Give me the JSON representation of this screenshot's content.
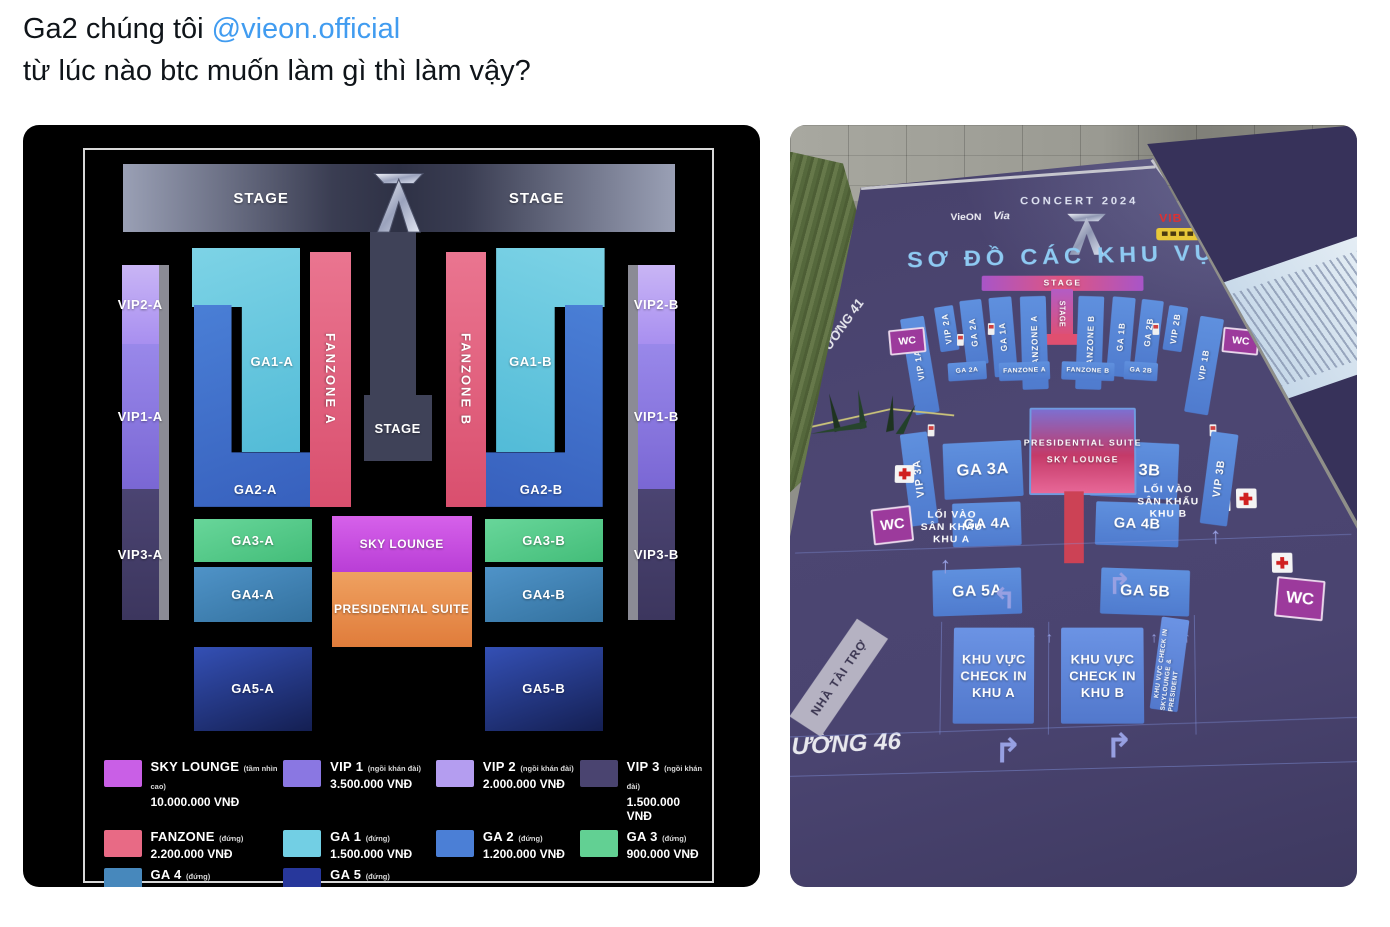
{
  "tweet": {
    "text_prefix": "Ga2 chúng tôi ",
    "mention": "@vieon.official",
    "line2": "từ lúc nào btc muốn làm gì thì làm vậy?"
  },
  "colors": {
    "link_blue": "#419cf0",
    "body_text": "#0f1419",
    "seatmap_bg": "#000000",
    "ga1": "#72cfe4",
    "ga2": "#4b7fd6",
    "ga3": "#62d093",
    "ga4": "#4788bc",
    "ga5": "#27379b",
    "fanzone": "#e86a85",
    "vip1": "#8a77e2",
    "vip2": "#b49df0",
    "vip3": "#4a4470",
    "sky_lounge": "#c95fe6",
    "presidential": "#e8914f",
    "photo_board_purple": "#47416b",
    "photo_zone_blue": "#5b8cd9",
    "photo_stage_pink": "#d4537c",
    "wc_magenta": "#9c3a9c",
    "photo_title_blue": "#8ecaf2"
  },
  "seat_map": {
    "stage_left": "STAGE",
    "stage_right": "STAGE",
    "stage_center": "STAGE",
    "zones": {
      "vip2a": "VIP2-A",
      "vip1a": "VIP1-A",
      "vip3a": "VIP3-A",
      "vip2b": "VIP2-B",
      "vip1b": "VIP1-B",
      "vip3b": "VIP3-B",
      "ga1a": "GA1-A",
      "ga2a": "GA2-A",
      "ga3a": "GA3-A",
      "ga4a": "GA4-A",
      "ga5a": "GA5-A",
      "ga1b": "GA1-B",
      "ga2b": "GA2-B",
      "ga3b": "GA3-B",
      "ga4b": "GA4-B",
      "ga5b": "GA5-B",
      "fanzone_a": "FANZONE A",
      "fanzone_b": "FANZONE B",
      "sky_lounge": "SKY LOUNGE",
      "presidential": "PRESIDENTIAL SUITE"
    },
    "legend": [
      {
        "name": "SKY LOUNGE",
        "note": "(tầm nhìn cao)",
        "price": "10.000.000 VNĐ",
        "color": "#c95fe6"
      },
      {
        "name": "VIP 1",
        "note": "(ngồi khán đài)",
        "price": "3.500.000 VNĐ",
        "color": "#8a77e2"
      },
      {
        "name": "VIP 2",
        "note": "(ngồi khán đài)",
        "price": "2.000.000 VNĐ",
        "color": "#b49df0"
      },
      {
        "name": "VIP 3",
        "note": "(ngồi khán đài)",
        "price": "1.500.000 VNĐ",
        "color": "#4a4470"
      },
      {
        "name": "FANZONE",
        "note": "(đứng)",
        "price": "2.200.000 VNĐ",
        "color": "#e86a85"
      },
      {
        "name": "GA 1",
        "note": "(đứng)",
        "price": "1.500.000 VNĐ",
        "color": "#72cfe4"
      },
      {
        "name": "GA 2",
        "note": "(đứng)",
        "price": "1.200.000 VNĐ",
        "color": "#4b7fd6"
      },
      {
        "name": "GA 3",
        "note": "(đứng)",
        "price": "900.000 VNĐ",
        "color": "#62d093"
      },
      {
        "name": "GA 4",
        "note": "(đứng)",
        "price": "700.000 VNĐ",
        "color": "#4788bc"
      },
      {
        "name": "GA 5",
        "note": "(đứng)",
        "price": "500.000 VNĐ",
        "color": "#27379b"
      }
    ]
  },
  "photo": {
    "concert_title": "CONCERT 2024",
    "board_title": "SƠ ĐỒ CÁC KHU VỰC",
    "logo_vieon": "VieON",
    "logo_via": "Via",
    "logo_vib": "VIB",
    "stage": "STAGE",
    "stage_runway": "STAGE",
    "columns": [
      "VIP 2A",
      "GA 2A",
      "GA 1A",
      "FANZONE A",
      "FANZONE B",
      "GA 1B",
      "GA 2B",
      "VIP 2B"
    ],
    "vip1a": "VIP 1A",
    "vip1b": "VIP 1B",
    "mid_row": [
      "GA 2A",
      "FANZONE A",
      "FANZONE B",
      "GA 2B"
    ],
    "foh": "FOH",
    "ga3a": "GA 3A",
    "ga3b": "GA 3B",
    "vip3a": "VIP 3A",
    "vip3b": "VIP 3B",
    "suite_line1": "PRESIDENTIAL SUITE",
    "suite_line2": "SKY LOUNGE",
    "ga4a": "GA 4A",
    "ga4b": "GA 4B",
    "ga5a": "GA 5A",
    "ga5b": "GA 5B",
    "wc": "WC",
    "entry_a": [
      "LỐI VÀO",
      "SÂN KHẤU",
      "KHU A"
    ],
    "entry_b": [
      "LỐI VÀO",
      "SÂN KHẤU",
      "KHU B"
    ],
    "checkin_a": [
      "KHU VỰC",
      "CHECK IN",
      "KHU A"
    ],
    "checkin_b": [
      "KHU VỰC",
      "CHECK IN",
      "KHU B"
    ],
    "checkin_sky": [
      "KHU VỰC CHECK IN",
      "SKYLOUNGE & PRESIDENT"
    ],
    "sponsor_band": "NHÀ TÀI TRỢ",
    "street_left": "ƯỜNG 41",
    "street_bottom": "ƯỜNG 46"
  }
}
